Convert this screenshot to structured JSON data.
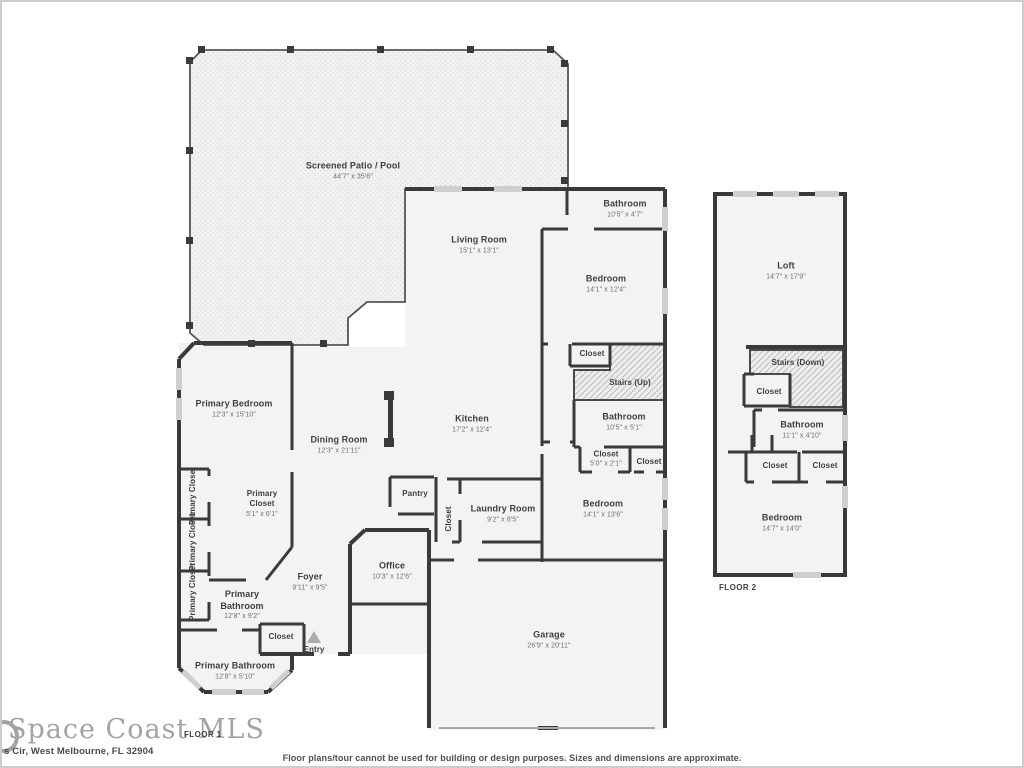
{
  "footer": {
    "watermark": "Space Coast MLS",
    "floor1_label": "FLOOR 1",
    "floor2_label": "FLOOR 2",
    "address": "s Cir, West Melbourne, FL 32904",
    "disclaimer": "Floor plans/tour cannot be used for building or design purposes. Sizes and dimensions are approximate."
  },
  "colors": {
    "wall": "#3a3a3a",
    "room_fill": "#f3f3f3",
    "patio_dot": "#d9d9d9",
    "hatch_line": "#bdbdbd",
    "window": "#cfcfcf",
    "label_text": "#3f3f3f",
    "dims_text": "#6e6e6e",
    "watermark": "#a3a3a3"
  },
  "floor1": {
    "rooms": {
      "patio": {
        "name": "Screened Patio / Pool",
        "dims": "44'7\" x 35'6\""
      },
      "living": {
        "name": "Living Room",
        "dims": "15'1\" x 13'1\""
      },
      "bath_top": {
        "name": "Bathroom",
        "dims": "10'5\" x 4'7\""
      },
      "bedroom_top": {
        "name": "Bedroom",
        "dims": "14'1\" x 12'4\""
      },
      "closet_hall": {
        "name": "Closet"
      },
      "stairs_up": {
        "name": "Stairs (Up)"
      },
      "bath_mid": {
        "name": "Bathroom",
        "dims": "10'5\" x 5'1\""
      },
      "closet_1": {
        "name": "Closet",
        "dims": "5'0\" x 2'1\""
      },
      "closet_2": {
        "name": "Closet"
      },
      "kitchen": {
        "name": "Kitchen",
        "dims": "17'2\" x 12'4\""
      },
      "dining": {
        "name": "Dining Room",
        "dims": "12'3\" x 21'11\""
      },
      "primary_bedroom": {
        "name": "Primary Bedroom",
        "dims": "12'3\" x 15'10\""
      },
      "primary_closet_a": {
        "name": "Primary Closet"
      },
      "primary_closet_b": {
        "name": "Primary Closet"
      },
      "primary_closet_c": {
        "name": "Primary Closet"
      },
      "primary_closet_main": {
        "name": "Primary Closet",
        "dims": "5'1\" x 6'1\""
      },
      "foyer": {
        "name": "Foyer",
        "dims": "9'11\" x 9'5\""
      },
      "primary_bath_upper": {
        "name": "Primary Bathroom",
        "dims": "12'8\" x 9'2\""
      },
      "closet_entry": {
        "name": "Closet"
      },
      "primary_bath_lower": {
        "name": "Primary Bathroom",
        "dims": "12'8\" x 5'10\""
      },
      "entry": {
        "name": "Entry"
      },
      "office": {
        "name": "Office",
        "dims": "10'3\" x 12'6\""
      },
      "pantry": {
        "name": "Pantry"
      },
      "closet_vert": {
        "name": "Closet"
      },
      "laundry": {
        "name": "Laundry Room",
        "dims": "9'2\" x 8'5\""
      },
      "bedroom_lower": {
        "name": "Bedroom",
        "dims": "14'1\" x 13'6\""
      },
      "garage": {
        "name": "Garage",
        "dims": "26'9\" x 20'11\""
      }
    }
  },
  "floor2": {
    "rooms": {
      "loft": {
        "name": "Loft",
        "dims": "14'7\" x 17'9\""
      },
      "stairs_down": {
        "name": "Stairs (Down)"
      },
      "closet_a": {
        "name": "Closet"
      },
      "bathroom": {
        "name": "Bathroom",
        "dims": "11'1\" x 4'10\""
      },
      "closet_b": {
        "name": "Closet"
      },
      "closet_c": {
        "name": "Closet"
      },
      "bedroom": {
        "name": "Bedroom",
        "dims": "14'7\" x 14'0\""
      }
    }
  }
}
